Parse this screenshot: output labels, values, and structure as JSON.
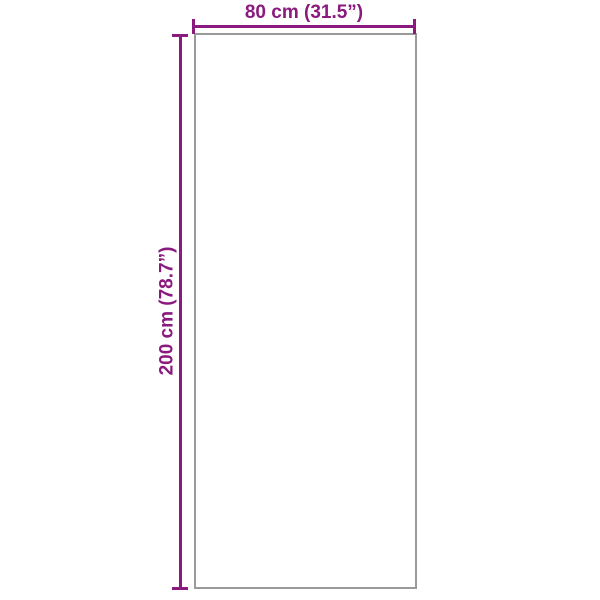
{
  "colors": {
    "accent": "#8A1A7D",
    "outline": "#9A9A9A",
    "background": "#FFFFFF"
  },
  "diagram": {
    "width_label": "80 cm (31.5”)",
    "height_label": "200 cm (78.7”)"
  }
}
